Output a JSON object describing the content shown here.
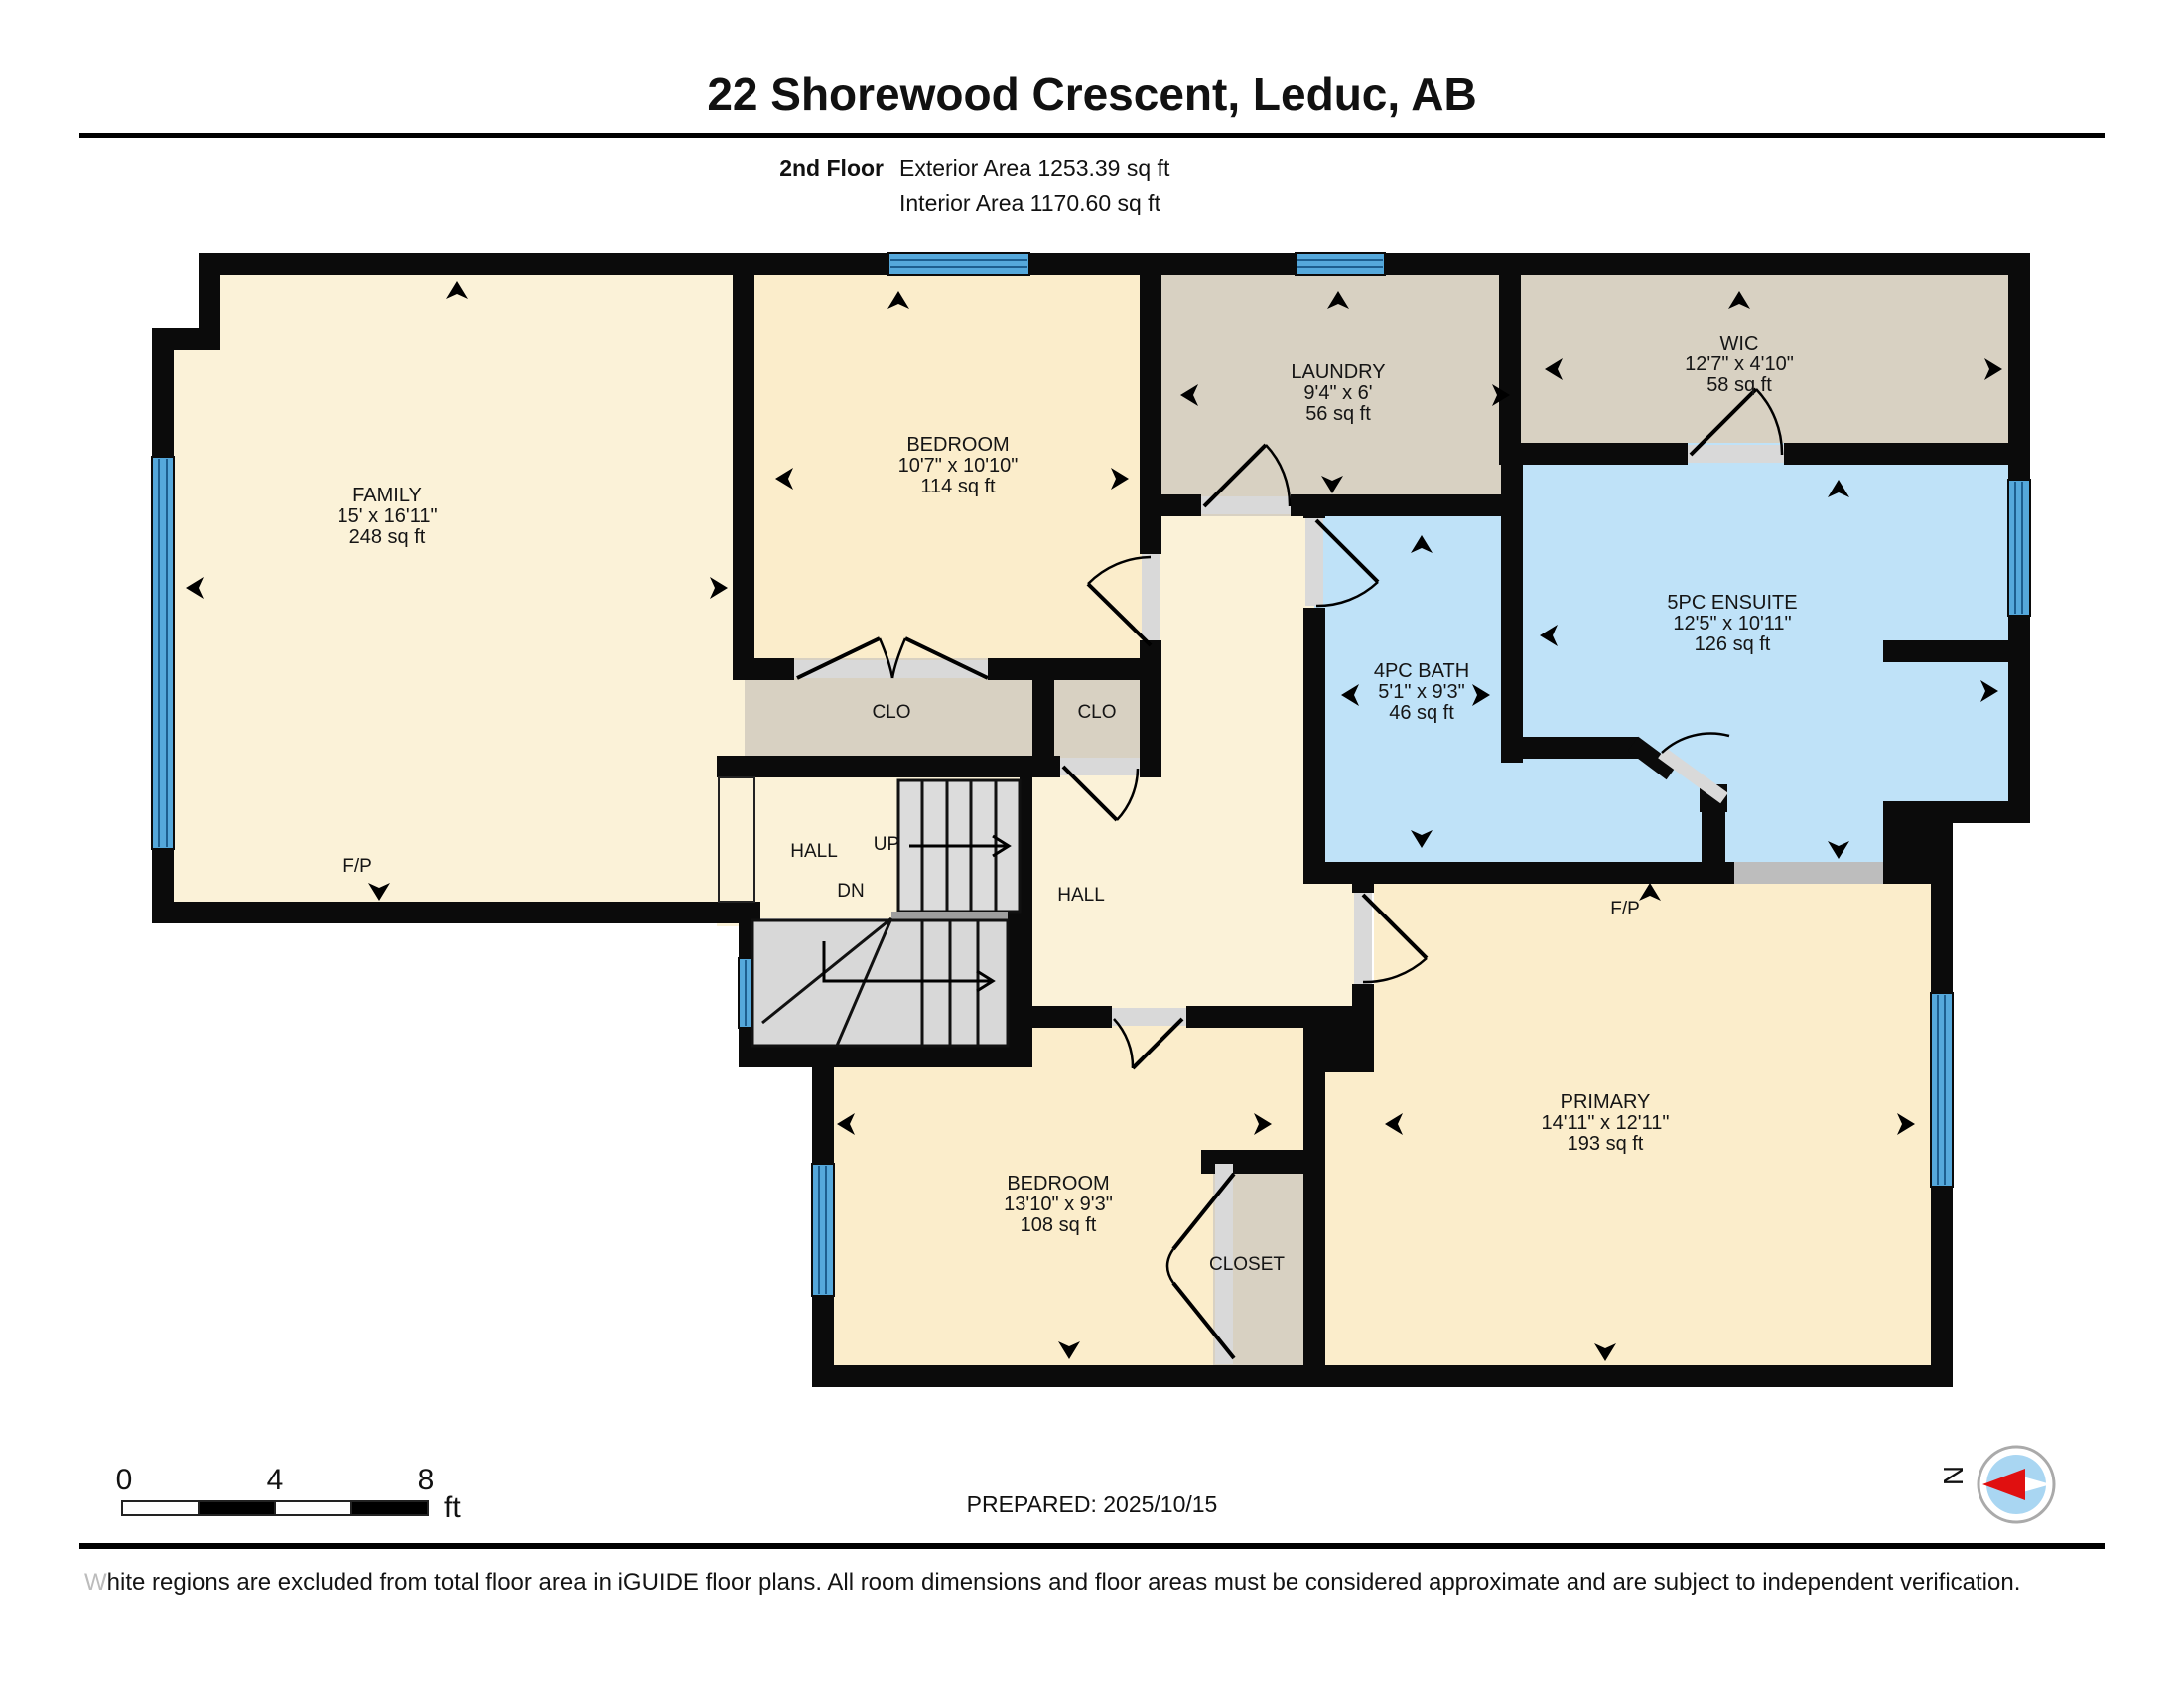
{
  "header": {
    "title": "22 Shorewood Crescent, Leduc, AB",
    "floor_label": "2nd Floor",
    "exterior_area": "Exterior Area 1253.39 sq ft",
    "interior_area": "Interior Area 1170.60 sq ft"
  },
  "rooms": {
    "family": {
      "name": "FAMILY",
      "dims": "15' x 16'11\"",
      "area": "248 sq ft"
    },
    "bedroom_top": {
      "name": "BEDROOM",
      "dims": "10'7\" x 10'10\"",
      "area": "114 sq ft"
    },
    "laundry": {
      "name": "LAUNDRY",
      "dims": "9'4\" x 6'",
      "area": "56 sq ft"
    },
    "wic": {
      "name": "WIC",
      "dims": "12'7\" x 4'10\"",
      "area": "58 sq ft"
    },
    "bath": {
      "name": "4PC BATH",
      "dims": "5'1\" x 9'3\"",
      "area": "46 sq ft"
    },
    "ensuite": {
      "name": "5PC ENSUITE",
      "dims": "12'5\" x 10'11\"",
      "area": "126 sq ft"
    },
    "bedroom_bottom": {
      "name": "BEDROOM",
      "dims": "13'10\" x 9'3\"",
      "area": "108 sq ft"
    },
    "primary": {
      "name": "PRIMARY",
      "dims": "14'11\" x 12'11\"",
      "area": "193 sq ft"
    }
  },
  "labels": {
    "clo_left": "CLO",
    "clo_right": "CLO",
    "closet": "CLOSET",
    "hall_left": "HALL",
    "hall_center": "HALL",
    "up": "UP",
    "dn": "DN",
    "fp_family": "F/P",
    "fp_primary": "F/P",
    "north": "N"
  },
  "scale_bar": {
    "ticks": [
      "0",
      "4",
      "8"
    ],
    "unit": "ft"
  },
  "footer": {
    "prepared": "PREPARED: 2025/10/15",
    "disclaimer_first": "W",
    "disclaimer_rest": "hite regions are excluded from total floor area in iGUIDE floor plans. All room dimensions and floor areas must be considered approximate and are subject to independent verification."
  },
  "colors": {
    "wall": "#0b0b0b",
    "room_cream": "#FBF2D8",
    "room_cream2": "#FBEDCB",
    "room_tan": "#D8D1C2",
    "room_blue": "#BFE2F8",
    "window_blue": "#55A8DB",
    "opening_gray": "#D9D9D9",
    "stair_gray": "#DCDCDC"
  }
}
